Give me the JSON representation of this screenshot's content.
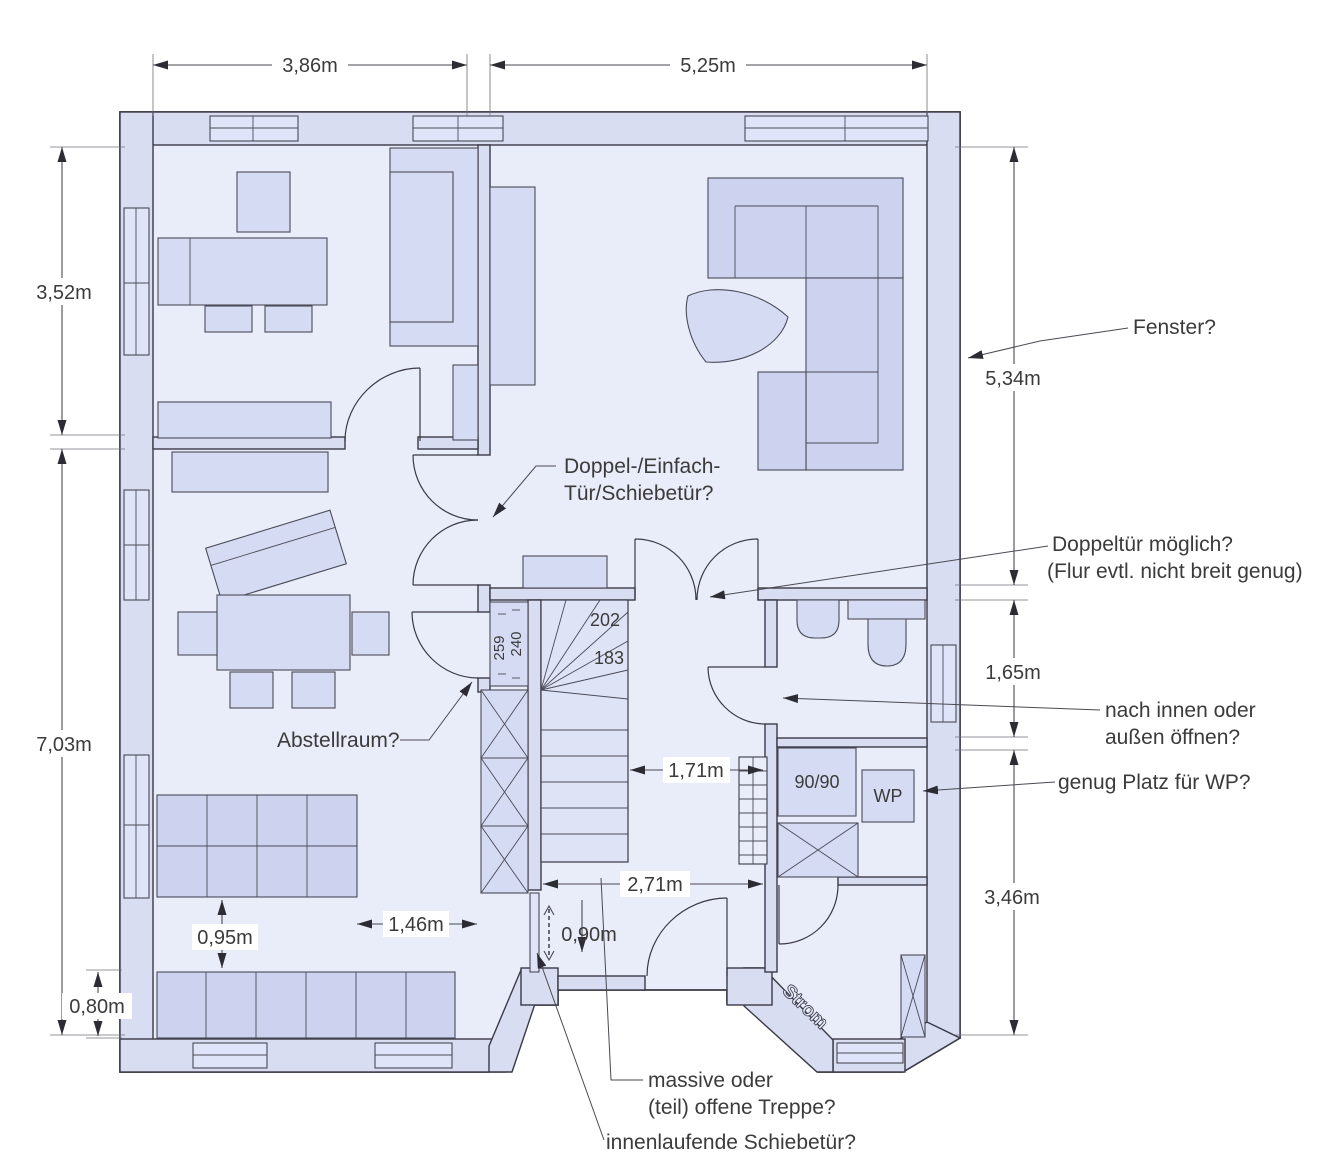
{
  "dims": {
    "top_left": "3,86m",
    "top_right": "5,25m",
    "left_upper": "3,52m",
    "left_lower": "7,03m",
    "left_bottom": "0,80m",
    "right_upper": "5,34m",
    "right_middle": "1,65m",
    "right_lower": "3,46m",
    "hall_width": "1,71m",
    "hall_total": "2,71m",
    "kitchen_gap": "1,46m",
    "kitchen_aisle": "0,95m",
    "sliding_opening": "0,90m"
  },
  "stairs": {
    "headroom_upper": "202",
    "headroom_lower": "183"
  },
  "closet": {
    "dim_a": "240",
    "dim_b": "259"
  },
  "equipment": {
    "shower": "90/90",
    "heat_pump": "WP",
    "electricity": "Strom"
  },
  "annotations": {
    "window": "Fenster?",
    "door_type_l1": "Doppel-/Einfach-",
    "door_type_l2": "Tür/Schiebetür?",
    "double_door_l1": "Doppeltür möglich?",
    "double_door_l2": "(Flur evtl. nicht breit genug)",
    "storage": "Abstellraum?",
    "door_swing_l1": "nach innen oder",
    "door_swing_l2": "außen öffnen?",
    "heat_pump_space": "genug Platz für WP?",
    "stair_l1": "massive oder",
    "stair_l2": "(teil) offene Treppe?",
    "sliding_door": "innenlaufende Schiebetür?"
  },
  "colors": {
    "wall": "#d9ddf2",
    "floor": "#e9ecf9",
    "furn": "#d6dbf4",
    "furn2": "#cdd3ef",
    "win": "#e0e4f8",
    "line": "#3a3a46",
    "text": "#3b3b3b"
  }
}
